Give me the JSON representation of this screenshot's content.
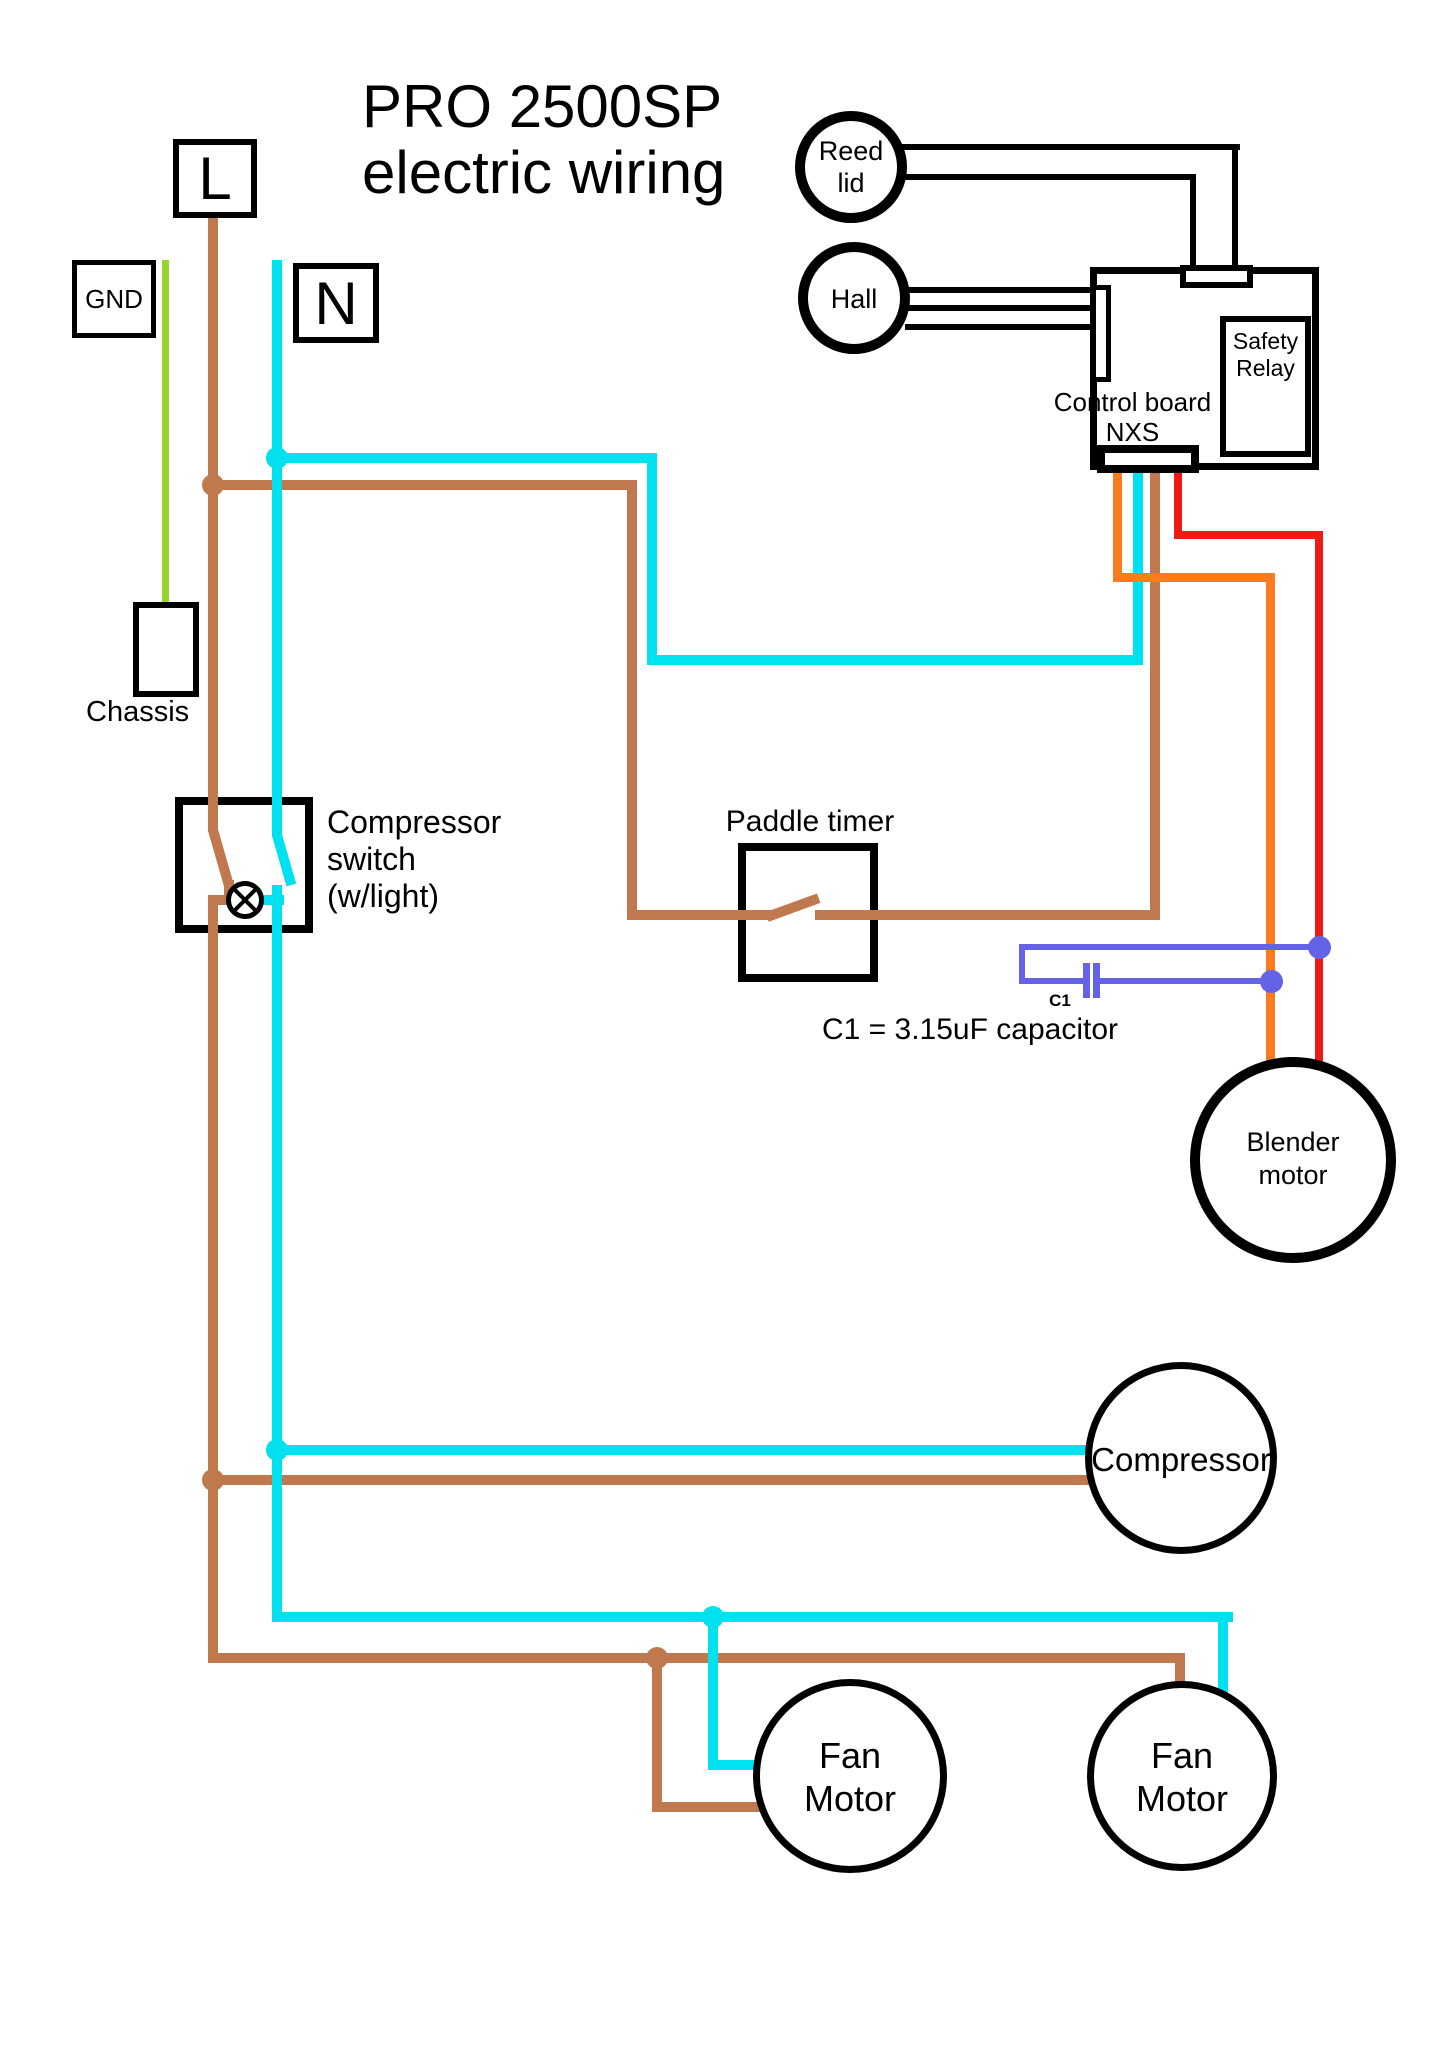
{
  "title": {
    "line1": "PRO 2500SP",
    "line2": "electric wiring"
  },
  "terminals": {
    "live": "L",
    "ground": "GND",
    "neutral": "N"
  },
  "chassis": {
    "label": "Chassis"
  },
  "sensors": {
    "reed": {
      "line1": "Reed",
      "line2": "lid"
    },
    "hall": {
      "label": "Hall"
    }
  },
  "control_board": {
    "label_line1": "Control board",
    "label_line2": "NXS",
    "safety_relay": {
      "line1": "Safety",
      "line2": "Relay"
    }
  },
  "compressor_switch": {
    "line1": "Compressor",
    "line2": "switch",
    "line3": "(w/light)"
  },
  "paddle_timer": {
    "label": "Paddle timer"
  },
  "capacitor": {
    "designator": "C1",
    "caption": "C1 = 3.15uF capacitor"
  },
  "motors": {
    "blender": {
      "line1": "Blender",
      "line2": "motor"
    },
    "compressor": {
      "label": "Compressor"
    },
    "fan_left": {
      "line1": "Fan",
      "line2": "Motor"
    },
    "fan_right": {
      "line1": "Fan",
      "line2": "Motor"
    }
  },
  "colors": {
    "live_brown": "#C0784E",
    "neutral_cyan": "#00E1EF",
    "ground_green": "#97D52C",
    "orange": "#FB7C20",
    "red": "#EE1B14",
    "capacitor_blue": "#6463E8",
    "signal_black": "#000000"
  }
}
